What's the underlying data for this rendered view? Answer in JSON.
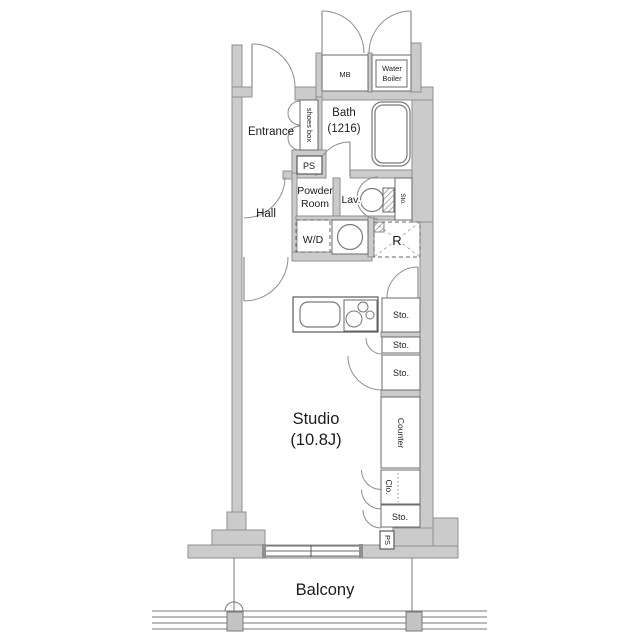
{
  "title": "Studio apartment floor plan",
  "colors": {
    "wall_fill": "#cbcbcb",
    "wall_stroke": "#8f8f8f",
    "line": "#5a5a5a",
    "text": "#1c1c1c"
  },
  "rooms": {
    "entrance": "Entrance",
    "hall": "Hall",
    "bath_line1": "Bath",
    "bath_line2": "(1216)",
    "powder_line1": "Powder",
    "powder_line2": "Room",
    "lav": "Lav.",
    "studio_line1": "Studio",
    "studio_line2": "(10.8J)",
    "balcony": "Balcony"
  },
  "fixtures": {
    "mb": "MB",
    "water_boiler_line1": "Water",
    "water_boiler_line2": "Boiler",
    "shoes_box": "shoes box",
    "ps_upper": "PS",
    "ps_lower": "PS",
    "wd": "W/D",
    "refrigerator": "R",
    "sto_lav": "Sto.",
    "sto_kitchen": "Sto.",
    "sto_mid1": "Sto.",
    "sto_mid2": "Sto.",
    "sto_bottom": "Sto.",
    "counter": "Counter",
    "closet": "Clo."
  }
}
